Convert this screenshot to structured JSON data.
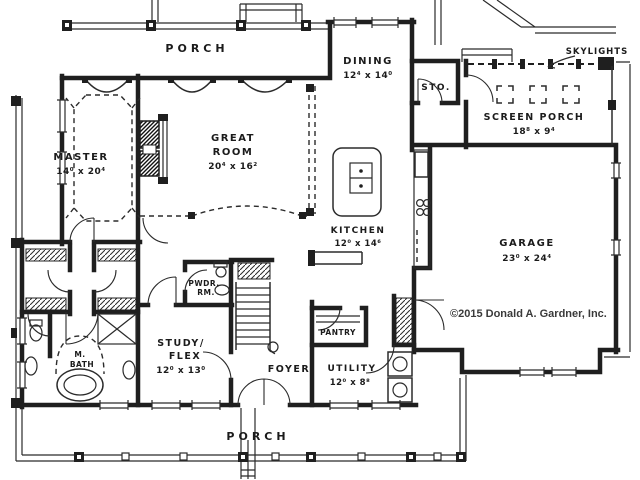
{
  "colors": {
    "ink": "#1f1f1f",
    "paper": "#ffffff",
    "text": "#1b1b1b"
  },
  "copyright": "©2015 Donald A. Gardner, Inc.",
  "rooms": {
    "porch_top": {
      "label": "PORCH"
    },
    "porch_bottom": {
      "label": "PORCH"
    },
    "master": {
      "label": "MASTER",
      "dims": "14⁰ x 20⁴"
    },
    "great_room": {
      "line1": "GREAT",
      "line2": "ROOM",
      "dims": "20⁴ x 16²"
    },
    "dining": {
      "label": "DINING",
      "dims": "12⁴ x 14⁰"
    },
    "storage": {
      "label": "STO."
    },
    "screen_porch": {
      "label": "SCREEN PORCH",
      "dims": "18⁸ x 9⁴"
    },
    "skylights": {
      "label": "SKYLIGHTS"
    },
    "kitchen": {
      "label": "KITCHEN",
      "dims": "12⁰ x 14⁶"
    },
    "garage": {
      "label": "GARAGE",
      "dims": "23⁰ x 24⁴"
    },
    "powder_room": {
      "line1": "PWDR.",
      "line2": "RM."
    },
    "study": {
      "line1": "STUDY/",
      "line2": "FLEX",
      "dims": "12⁰ x 13⁰"
    },
    "foyer": {
      "label": "FOYER"
    },
    "master_bath": {
      "line1": "M.",
      "line2": "BATH"
    },
    "pantry": {
      "label": "PANTRY"
    },
    "utility": {
      "label": "UTILITY",
      "dims": "12⁰ x 8⁸"
    }
  }
}
